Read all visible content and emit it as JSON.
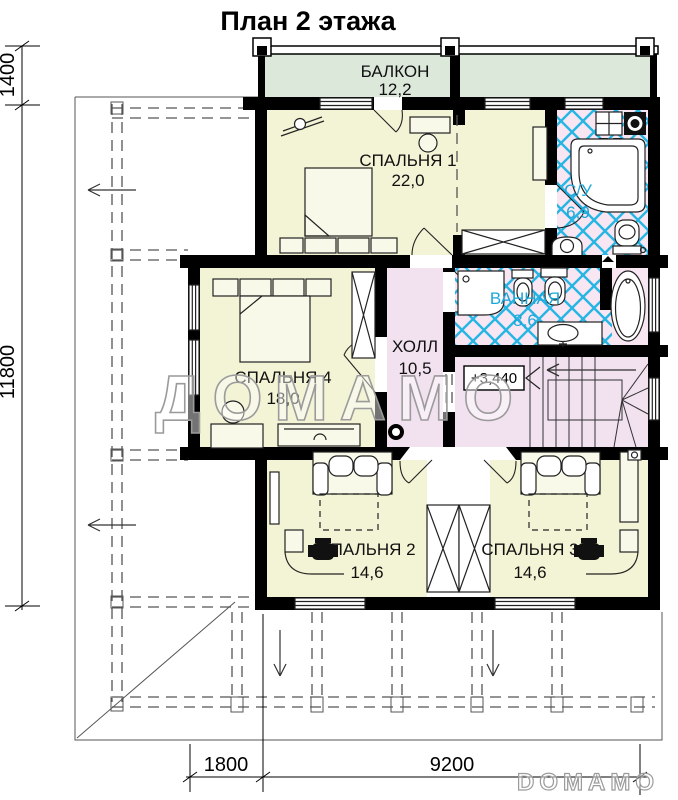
{
  "title": "План 2 этажа",
  "rooms": {
    "balcony": {
      "name": "БАЛКОН",
      "area": "12,2"
    },
    "bedroom1": {
      "name": "СПАЛЬНЯ 1",
      "area": "22,0"
    },
    "su": {
      "name": "С/У",
      "area": "6,9"
    },
    "bathroom": {
      "name": "ВАННАЯ",
      "area": "8,6"
    },
    "hall": {
      "name": "ХОЛЛ",
      "area": "10,5"
    },
    "bedroom4": {
      "name": "СПАЛЬНЯ 4",
      "area": "18,0"
    },
    "bedroom2": {
      "name": "СПАЛЬНЯ 2",
      "area": "14,6"
    },
    "bedroom3": {
      "name": "СПАЛЬНЯ 3",
      "area": "14,6"
    }
  },
  "elevation": {
    "mark": "+3,440"
  },
  "dimensions": {
    "left_top": "1400",
    "left_side": "11800",
    "bottom_offset": "1800",
    "bottom_width": "9200"
  },
  "watermark": {
    "center": "ДОМАМО",
    "bottom": "DOMAMO"
  },
  "colors": {
    "wall": "#000000",
    "balcony_fill": "#dce8da",
    "bedroom_fill": "#f3f3d5",
    "hall_fill": "#f2e2f0",
    "bath_fill": "#f8e6f2",
    "tile_line": "#27b6e3",
    "bath_label": "#1ba7d9"
  }
}
